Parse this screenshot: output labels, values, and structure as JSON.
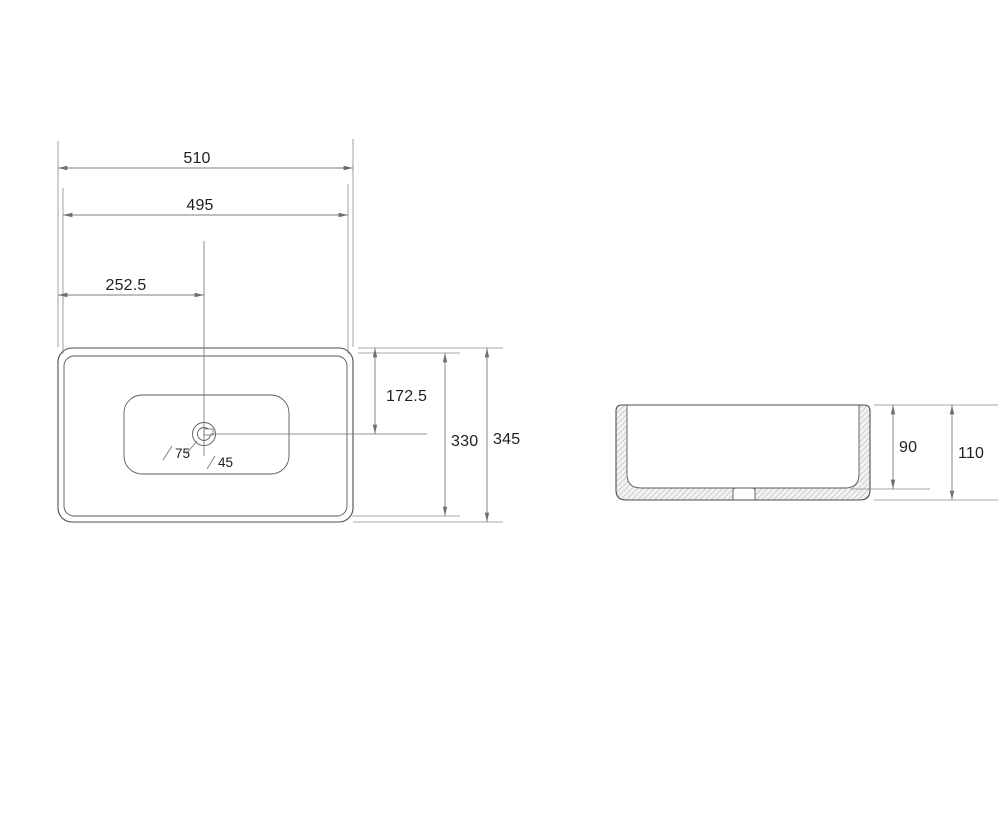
{
  "top_view": {
    "dim_overall_width": "510",
    "dim_inner_width": "495",
    "dim_drain_offset_x": "252.5",
    "dim_drain_offset_y": "172.5",
    "dim_inner_depth": "330",
    "dim_overall_depth": "345",
    "drain_outer_diameter": "75",
    "drain_inner_diameter": "45"
  },
  "section_view": {
    "dim_bowl_depth": "90",
    "dim_overall_height": "110"
  },
  "colors": {
    "outline": "#4d4d4d",
    "dimension_line": "#7c7c7c",
    "label_text": "#1f1f1f",
    "hatch": "#9a9a9a",
    "background": "#ffffff"
  }
}
